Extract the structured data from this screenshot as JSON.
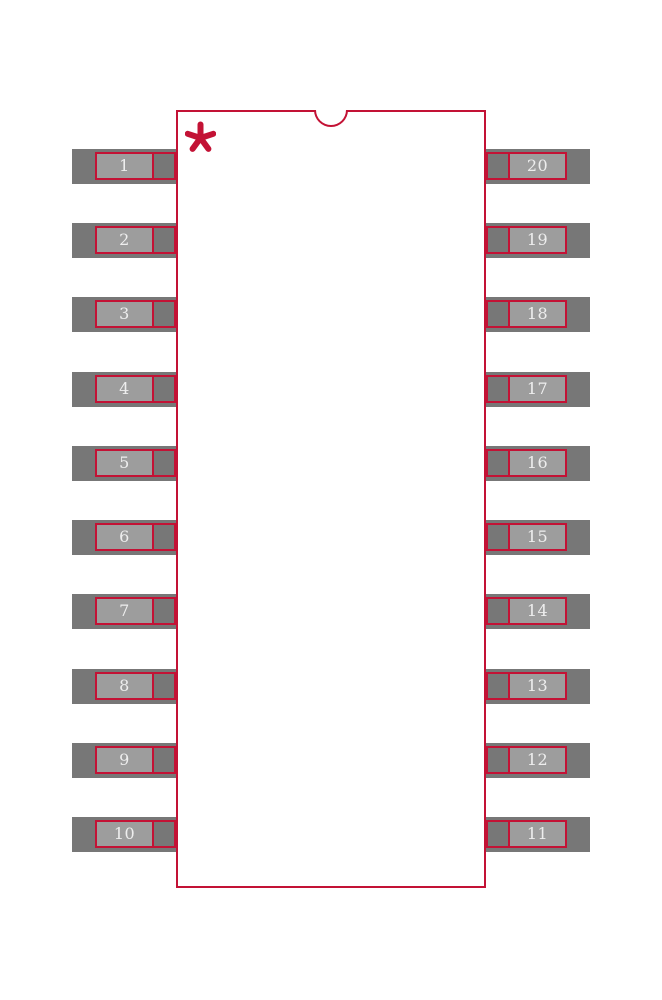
{
  "diagram": {
    "title": "20-pin dual-row IC footprint (SOIC-20 land pattern)",
    "pin_count": 20,
    "colors": {
      "background": "#ffffff",
      "pad_dark": "#777777",
      "pad_light": "#9d9d9d",
      "outline_red": "#c31235",
      "pin_number_text": "#eeeeee"
    },
    "body": {
      "x": 176,
      "y": 110,
      "width": 310,
      "height": 778
    },
    "notch": {
      "center_x": 331,
      "radius": 17
    },
    "pin1_marker": {
      "symbol": "asterisk",
      "x": 185,
      "y": 121,
      "size": 31
    },
    "rows": {
      "centers_y": [
        166,
        240,
        314,
        389,
        463,
        537,
        611,
        686,
        760,
        834
      ]
    },
    "geometry": {
      "pad_height": 35,
      "lead_height": 28,
      "left": {
        "pad_x": 72,
        "pad_w": 104,
        "lead_x": 95,
        "lead_w": 81,
        "inner_x": 95,
        "inner_w": 59
      },
      "right": {
        "pad_x": 486,
        "pad_w": 104,
        "lead_x": 486,
        "lead_w": 81,
        "inner_x": 508,
        "inner_w": 59
      }
    },
    "pads": {
      "left_numbers": [
        "1",
        "2",
        "3",
        "4",
        "5",
        "6",
        "7",
        "8",
        "9",
        "10"
      ],
      "right_numbers": [
        "20",
        "19",
        "18",
        "17",
        "16",
        "15",
        "14",
        "13",
        "12",
        "11"
      ]
    }
  }
}
